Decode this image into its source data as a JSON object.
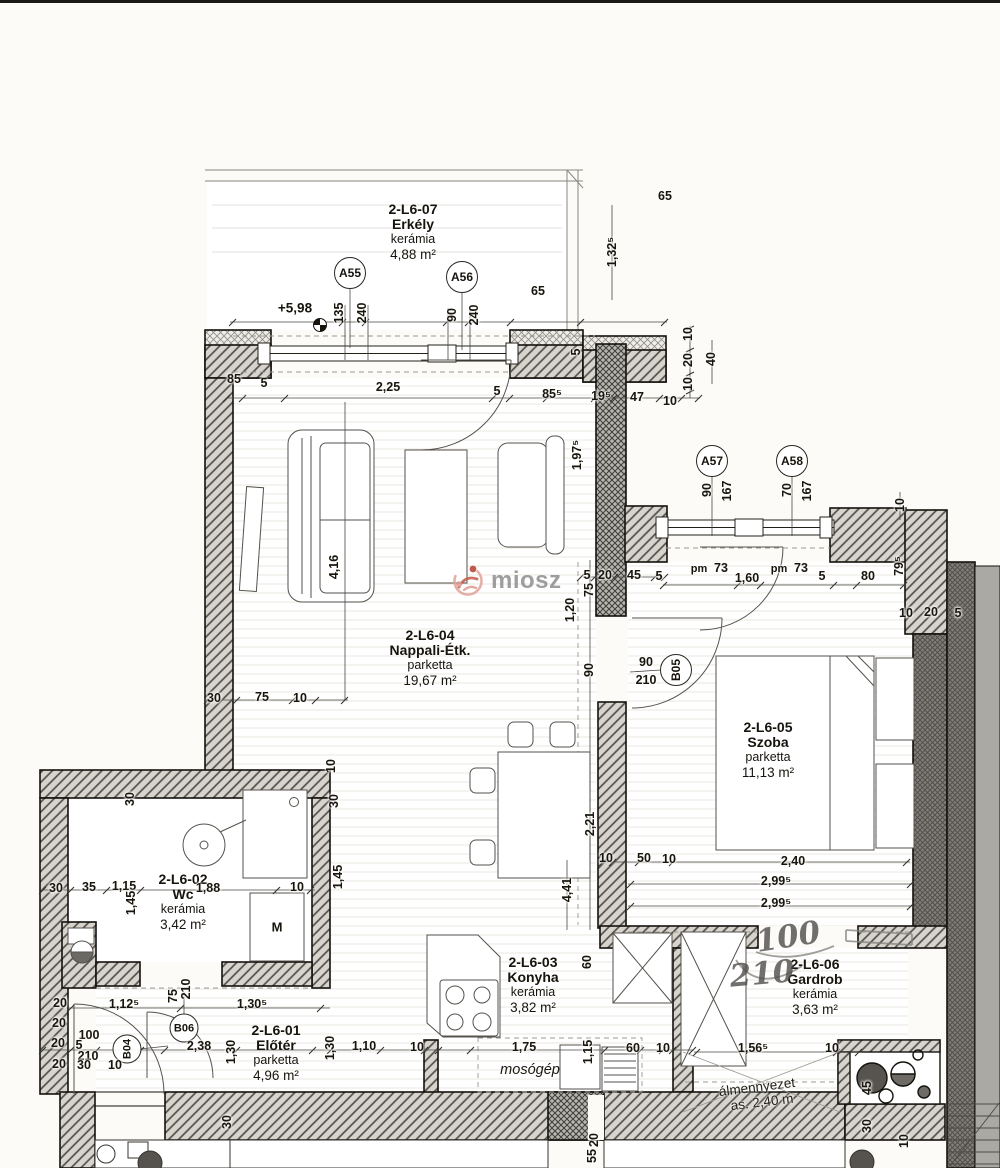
{
  "meta": {
    "watermark": "miosz"
  },
  "rooms": [
    {
      "id": "2-L6-07",
      "name": "Erkély",
      "finish": "kerámia",
      "area": "4,88 m²"
    },
    {
      "id": "2-L6-04",
      "name": "Nappali-Étk.",
      "finish": "parketta",
      "area": "19,67 m²"
    },
    {
      "id": "2-L6-05",
      "name": "Szoba",
      "finish": "parketta",
      "area": "11,13 m²"
    },
    {
      "id": "2-L6-02",
      "name": "Wc",
      "finish": "kerámia",
      "area": "3,42 m²"
    },
    {
      "id": "2-L6-03",
      "name": "Konyha",
      "finish": "kerámia",
      "area": "3,82 m²"
    },
    {
      "id": "2-L6-01",
      "name": "Előtér",
      "finish": "parketta",
      "area": "4,96 m²"
    },
    {
      "id": "2-L6-06",
      "name": "Gardrob",
      "finish": "kerámia",
      "area": "3,63 m²"
    }
  ],
  "markers": [
    {
      "label": "A55"
    },
    {
      "label": "A56"
    },
    {
      "label": "A57"
    },
    {
      "label": "A58"
    },
    {
      "label": "B05"
    },
    {
      "label": "B06"
    },
    {
      "label": "B04"
    }
  ],
  "annotations": {
    "level": "+5,98",
    "machine": "M",
    "washer_label": "mosógép",
    "ceiling_line1": "álmennyezet",
    "ceiling_line2": "as. 2,40 m",
    "hand_width": "100",
    "hand_height": "210"
  },
  "dims": [
    "135",
    "240",
    "90",
    "240",
    "65",
    "1,32⁵",
    "85",
    "5",
    "2,25",
    "5",
    "85⁵",
    "19⁵",
    "47",
    "10",
    "10",
    "20",
    "10",
    "40",
    "90",
    "167",
    "70",
    "167",
    "pm",
    "73",
    "1,60",
    "pm",
    "73",
    "5",
    "80",
    "79⁵",
    "10",
    "20",
    "5",
    "10",
    "5",
    "20",
    "45",
    "5",
    "75",
    "1,20",
    "90",
    "90",
    "210",
    "30",
    "75",
    "10",
    "10",
    "30",
    "4,16",
    "30",
    "35",
    "1,15",
    "1,45",
    "1,88",
    "10",
    "10",
    "50",
    "10",
    "2,40",
    "2,99⁵",
    "2,99⁵",
    "2,21",
    "4,41",
    "1,45",
    "1,30",
    "1,10",
    "10",
    "1,75",
    "1,15",
    "60",
    "10",
    "60",
    "20",
    "20",
    "20",
    "20",
    "100",
    "5",
    "210",
    "30",
    "10",
    "1,12⁵",
    "75",
    "210",
    "2,38",
    "1,30⁵",
    "1,30",
    "1,56⁵",
    "10",
    "45",
    "30",
    "10",
    "30",
    "20",
    "55",
    "1,97⁵",
    "5",
    "30",
    "65"
  ]
}
